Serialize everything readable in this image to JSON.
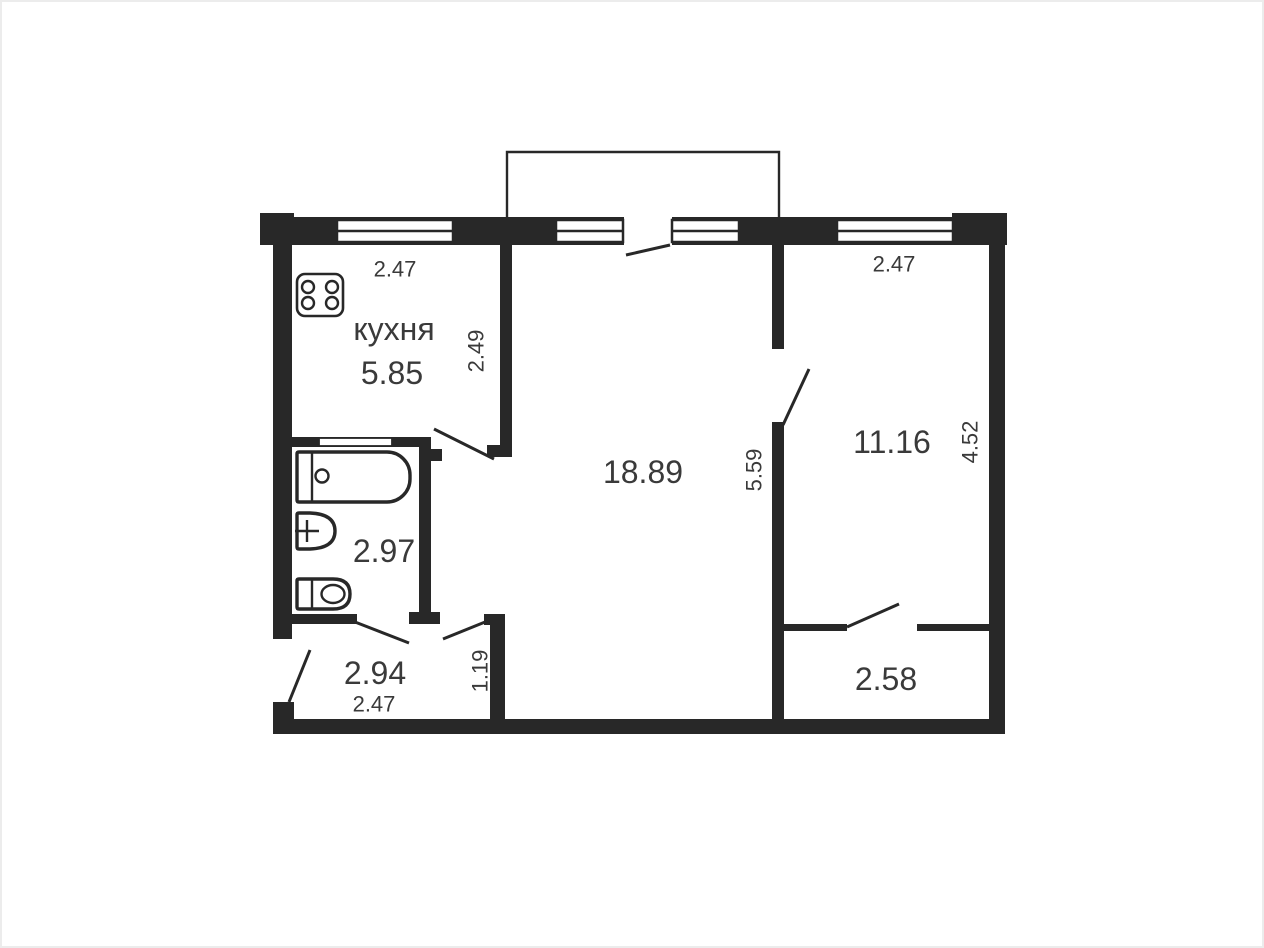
{
  "plan": {
    "type": "apartment-floor-plan",
    "colors": {
      "wall": "#282828",
      "text": "#3a3a3a",
      "background": "#ffffff",
      "border": "#ececec"
    },
    "rooms": [
      {
        "key": "kitchen",
        "name": "кухня",
        "area_m2": "5.85",
        "width_m": "2.47",
        "depth_m": "2.49"
      },
      {
        "key": "living",
        "area_m2": "18.89",
        "depth_m": "5.59"
      },
      {
        "key": "bedroom",
        "area_m2": "11.16",
        "width_m": "2.47",
        "depth_m": "4.52"
      },
      {
        "key": "bathroom",
        "area_m2": "2.97"
      },
      {
        "key": "hallway",
        "area_m2": "2.94",
        "width_m": "2.47",
        "depth_m": "1.19"
      },
      {
        "key": "small-room",
        "area_m2": "2.58"
      }
    ],
    "fixtures": [
      "stove",
      "bathtub",
      "sink",
      "toilet"
    ],
    "features": [
      "balcony",
      "windows",
      "door-swings"
    ]
  }
}
